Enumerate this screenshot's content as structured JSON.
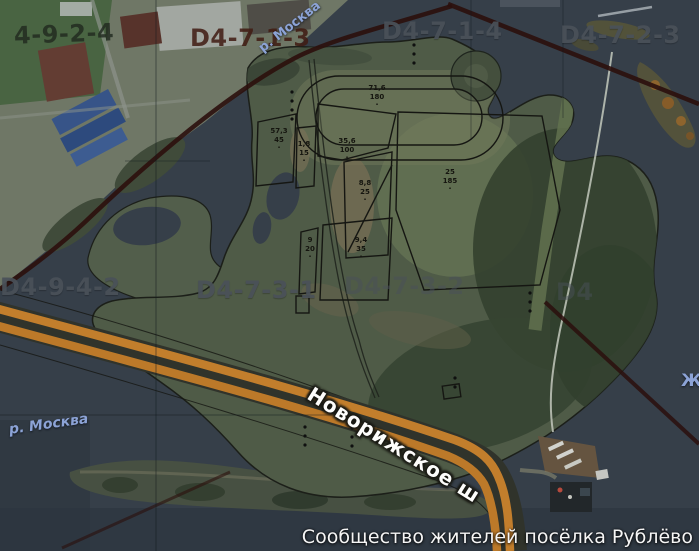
{
  "title_caption": "Сообщество жителей посёлка Рублёво",
  "map": {
    "road_label": {
      "text": "Новорижское ш"
    },
    "parcel_tick": "·",
    "grid_labels": [
      {
        "text": "4-9-2-4",
        "style": "dark",
        "x": 14,
        "y": 20,
        "rotate": -2
      },
      {
        "text": "D4-7-1-3",
        "style": "maroon",
        "x": 190,
        "y": 24,
        "rotate": 0
      },
      {
        "text": "D4-7-1-4",
        "style": "gray",
        "x": 382,
        "y": 17,
        "rotate": 0
      },
      {
        "text": "D4-7-2-3",
        "style": "gray",
        "x": 560,
        "y": 21,
        "rotate": 0
      },
      {
        "text": "D4-9-4-2",
        "style": "gray",
        "x": 0,
        "y": 273,
        "rotate": 0
      },
      {
        "text": "D4-7-3-1",
        "style": "gray",
        "x": 196,
        "y": 276,
        "rotate": 0
      },
      {
        "text": "D4-7-3-2",
        "style": "faint",
        "x": 344,
        "y": 272,
        "rotate": 0
      },
      {
        "text": "D4",
        "style": "faint",
        "x": 556,
        "y": 278,
        "rotate": 0
      }
    ],
    "water_labels": [
      {
        "text": "р. Москва",
        "x": 256,
        "y": 44,
        "rotate": -38,
        "size": 13,
        "italic": false
      },
      {
        "text": "р. Москва",
        "x": 8,
        "y": 422,
        "rotate": -8,
        "size": 14,
        "italic": true
      },
      {
        "text": "Ж",
        "x": 681,
        "y": 371,
        "rotate": 0,
        "size": 17,
        "italic": false
      }
    ],
    "parcels": [
      {
        "line1": "71,6",
        "line2": "180",
        "cx": 377,
        "cy": 84
      },
      {
        "line1": "57,3",
        "line2": "45",
        "cx": 279,
        "cy": 127
      },
      {
        "line1": "1,8",
        "line2": "15",
        "cx": 304,
        "cy": 140
      },
      {
        "line1": "35,6",
        "line2": "100",
        "cx": 347,
        "cy": 137
      },
      {
        "line1": "8,8",
        "line2": "25",
        "cx": 365,
        "cy": 179
      },
      {
        "line1": "9",
        "line2": "20",
        "cx": 310,
        "cy": 236
      },
      {
        "line1": "9,4",
        "line2": "35",
        "cx": 361,
        "cy": 236
      },
      {
        "line1": "25",
        "line2": "185",
        "cx": 450,
        "cy": 168
      }
    ],
    "colors": {
      "water": "#39424c",
      "land_dark_forest": "#36452f",
      "land_meadow": "#6f7d5a",
      "road_orange": "#d5882c",
      "boundary_dark_red": "#2d0d09",
      "grid_label_gray": "#4a5159",
      "river_label_blue": "#8ca3d6",
      "caption_white": "#f5f5f5"
    }
  }
}
